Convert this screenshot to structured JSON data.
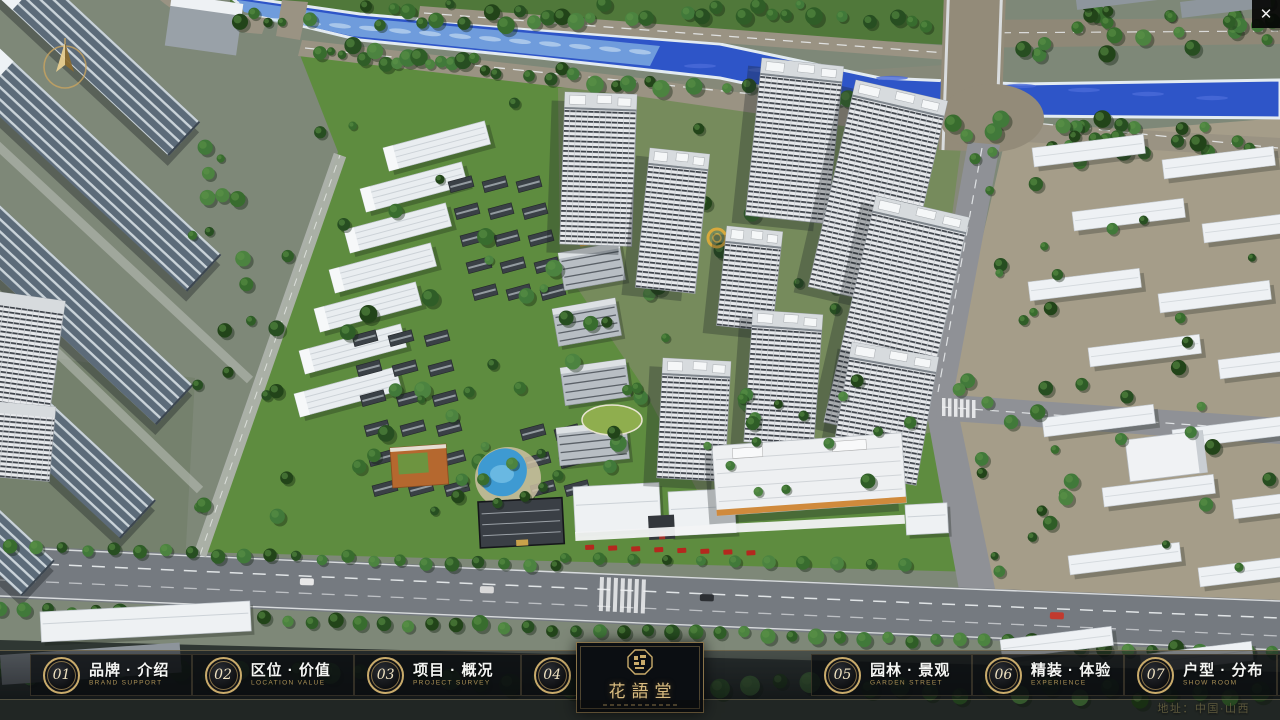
{
  "header": {
    "close_symbol": "✕"
  },
  "nav": {
    "items": [
      {
        "num": "01",
        "label": "品牌 · 介绍",
        "sub": "BRAND SUPPORT"
      },
      {
        "num": "02",
        "label": "区位 · 价值",
        "sub": "LOCATION VALUE"
      },
      {
        "num": "03",
        "label": "项目 · 概况",
        "sub": "PROJECT SURVEY"
      },
      {
        "num": "04",
        "label": "建筑 · 鉴赏",
        "sub": "APPRECIATION"
      },
      {
        "num": "05",
        "label": "园林 · 景观",
        "sub": "GARDEN STREET"
      },
      {
        "num": "06",
        "label": "精装 · 体验",
        "sub": "EXPERIENCE"
      },
      {
        "num": "07",
        "label": "户型 · 分布",
        "sub": "SHOW ROOM"
      },
      {
        "num": "08",
        "label": "一房 · 一景",
        "sub": "COMMUNITY"
      }
    ]
  },
  "logo": {
    "title": "花語堂"
  },
  "footer": {
    "address": "地址：中国·山西"
  },
  "colors": {
    "gold": "#c9ab6b",
    "gold_dim": "#ad9257",
    "panel_bg": "#0b0e12",
    "river": "#2e55c8",
    "grass": "#5e8c3f"
  }
}
